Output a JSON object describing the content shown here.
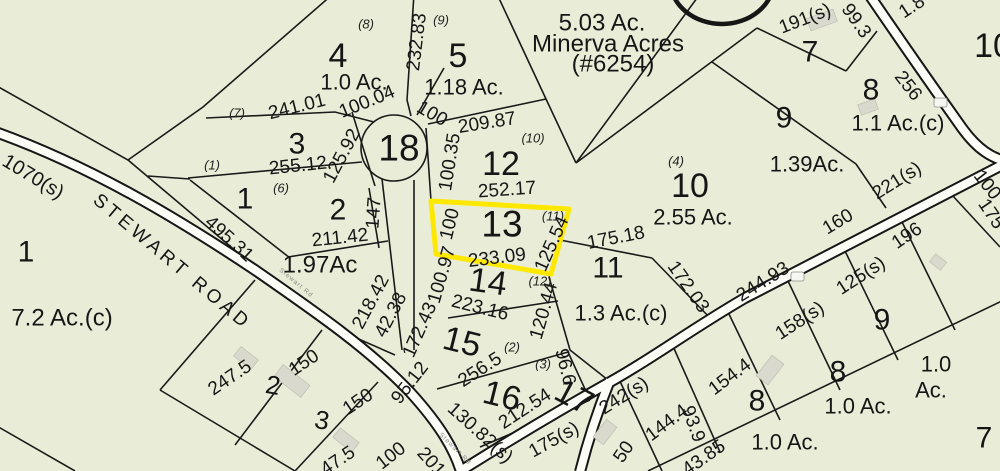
{
  "map": {
    "background_color": "#e9edd8",
    "boundary_color": "#1a1a1a",
    "highlight_color": "#ffe800",
    "road_fill_color": "#fdfdf8",
    "subdivision": {
      "acreage": "5.03 Ac.",
      "name": "Minerva Acres",
      "plat_number": "(#6254)"
    },
    "roads": {
      "stewart_road_label": "STEWART ROAD",
      "stewart_rd_small_label": "Stewart Rd",
      "stewart_frontage": "1070(s)"
    },
    "parcels": {
      "lot4": {
        "number": "4",
        "ref": "(8)",
        "acreage": "1.0 Ac."
      },
      "lot5": {
        "number": "5",
        "ref": "(9)",
        "acreage": "1.18 Ac."
      },
      "lot18": {
        "number": "18"
      },
      "lot3": {
        "number": "3",
        "ref": "(7)"
      },
      "lot1": {
        "number": "1",
        "ref": "(1)",
        "acreage": "1.97Ac"
      },
      "lot2": {
        "number": "2",
        "ref": "(6)"
      },
      "lot12": {
        "number": "12",
        "ref": "(10)"
      },
      "lot13": {
        "number": "13",
        "ref": "(11)",
        "highlighted": true
      },
      "lot14": {
        "number": "14",
        "ref": "(12)"
      },
      "lot15": {
        "number": "15",
        "ref": "(2)"
      },
      "lot16": {
        "number": "16",
        "ref": "(3)"
      },
      "lot17": {
        "number": "17"
      },
      "lot10": {
        "number": "10",
        "ref": "(4)",
        "acreage": "2.55 Ac."
      },
      "lot11": {
        "number": "11",
        "acreage": "1.3 Ac.(c)"
      },
      "parcel_west": {
        "number": "1",
        "acreage": "7.2 Ac.(c)"
      },
      "lot7_north": {
        "number": "7"
      },
      "lot8_north": {
        "number": "8",
        "acreage": "1.1 Ac.(c)"
      },
      "lot9_north": {
        "number": "9",
        "acreage": "1.39Ac."
      },
      "lot9_south": {
        "number": "9",
        "acreage_line1": "1.0",
        "acreage_line2": "Ac."
      },
      "lot8_mid": {
        "number": "8",
        "acreage": "1.0 Ac."
      },
      "lot8_south": {
        "number": "8",
        "acreage": "1.0 Ac."
      },
      "lot7_south": {
        "number": "7"
      },
      "lot2_south": {
        "number": "2"
      },
      "lot3_south": {
        "number": "3"
      },
      "lot10_edge": {
        "number": "10"
      }
    },
    "dimensions": {
      "d232_83": "232.83",
      "d241_01": "241.01",
      "d100_04": "100.04",
      "d100_a": "100",
      "d209_87": "209.87",
      "d100_35": "100.35",
      "d125_92": "125.92",
      "d255_12": "255.12",
      "d147": "147",
      "d211_42": "211.42",
      "d495_31": "495.31",
      "d252_17": "252.17",
      "d233_09": "233.09",
      "d100_b": "100",
      "d125_54": "125.54",
      "d175_18": "175.18",
      "d172_03": "172.03",
      "d244_93": "244.93",
      "d120_44": "120.44",
      "d223_16": "223.16",
      "d100_97": "100.97",
      "d172_43": "172.43",
      "d218_42": "218.42",
      "d42_38": "42.38",
      "d95_12": "95.12",
      "d256_5": "256.5",
      "d96_6": "96.6",
      "d212_54": "212.54",
      "d130_82": "130.82(s)",
      "d175_s": "175(s)",
      "d242_s": "242(s)",
      "d201": "201",
      "d100_c": "100",
      "d247_5": "247.5",
      "d150_a": "150",
      "d150_b": "150",
      "d47_5": "47.5",
      "d191_s": "191(s)",
      "d99_3": "99.3",
      "d1_8": "1.8",
      "d256": "256",
      "d221_s": "221(s)",
      "d160": "160",
      "d196": "196",
      "d125_s": "125(s)",
      "d158_s": "158(s)",
      "d154_4": "154.4",
      "d144_4": "144.4",
      "d93_9": "93.9",
      "d50": "50",
      "d43_85": "43.85",
      "d100_d": "100",
      "d175_r": "175"
    }
  }
}
